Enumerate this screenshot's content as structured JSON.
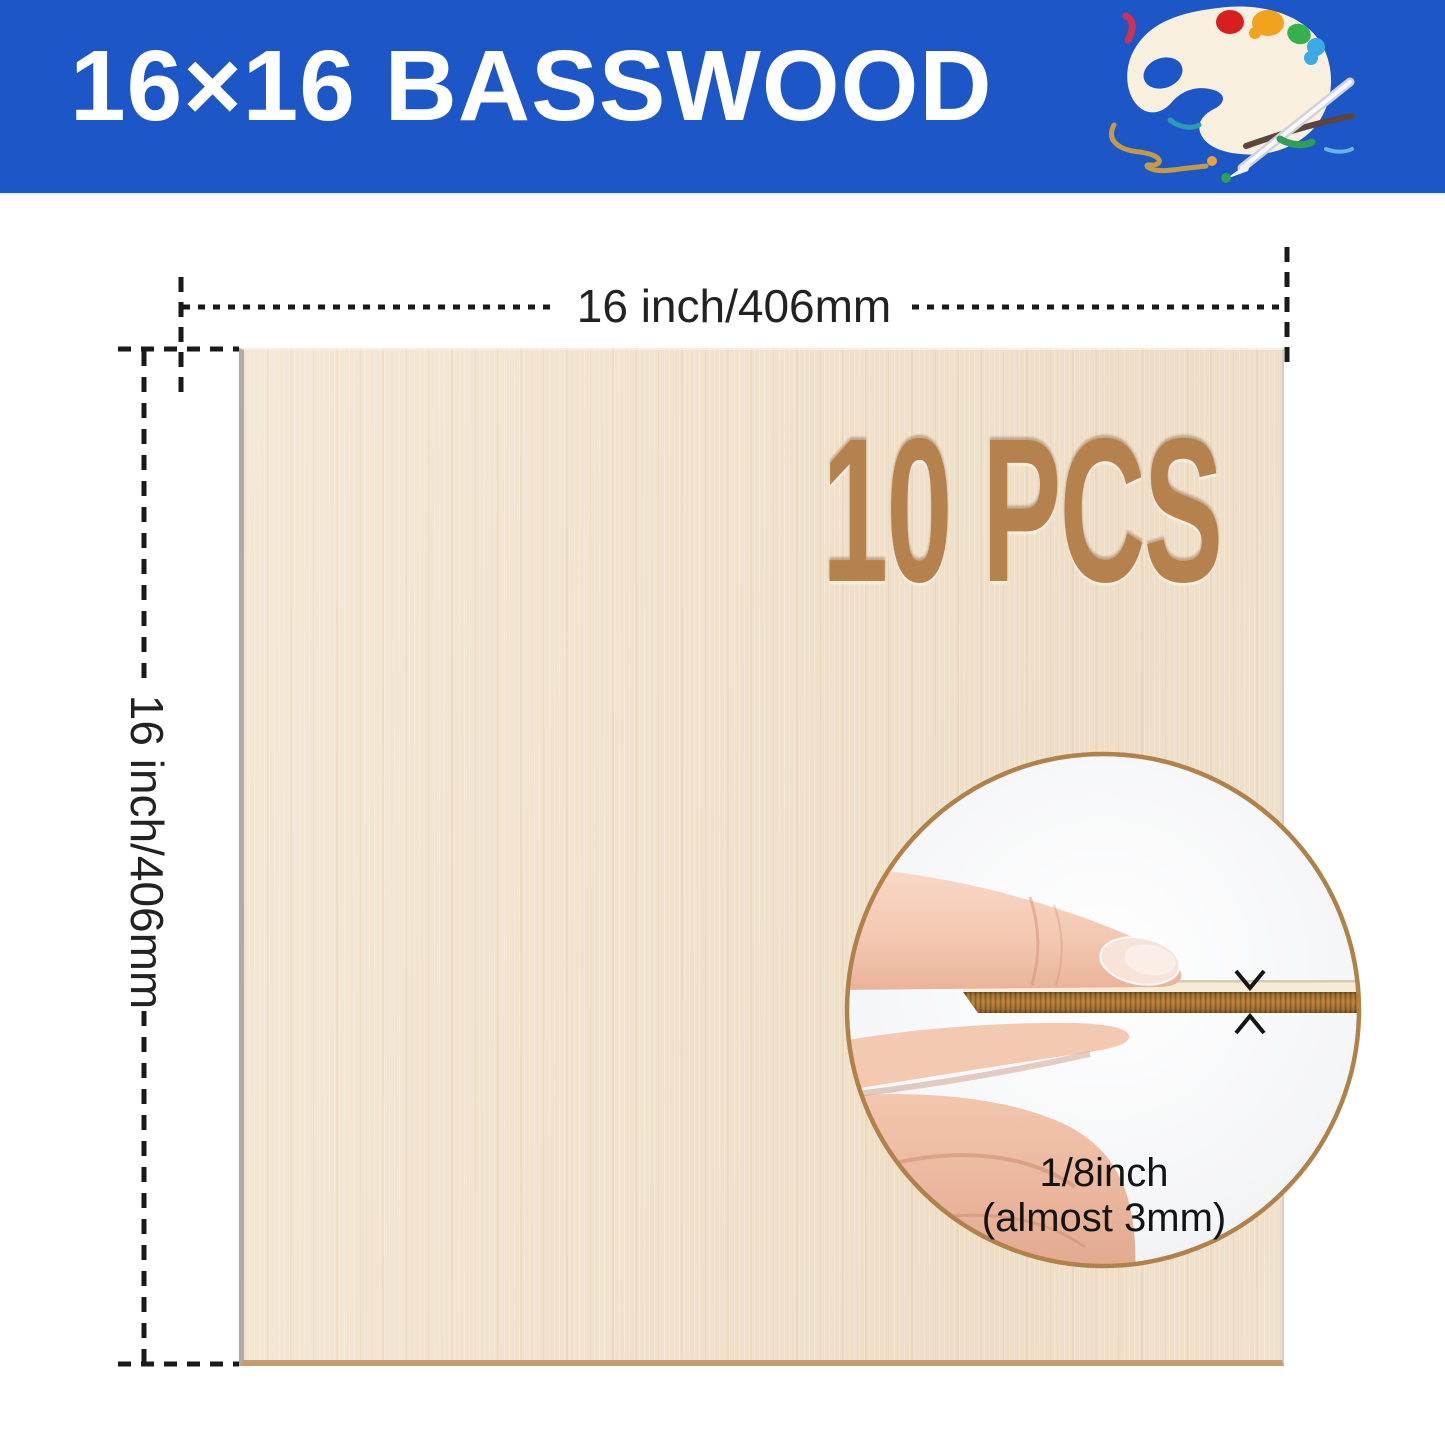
{
  "header": {
    "title": "16×16 BASSWOOD",
    "background_color": "#1d56c7",
    "title_color": "#ffffff"
  },
  "dimensions": {
    "width_label": "16 inch/406mm",
    "height_label": "16 inch/406mm",
    "line_color": "#1a1a1a"
  },
  "board": {
    "count_label": "10 PCS",
    "count_color": "#b5824e",
    "surface_color": "#f1e2cd",
    "edge_bottom_color": "#c49d72"
  },
  "inset": {
    "thickness_line1": "1/8inch",
    "thickness_line2": "(almost 3mm)",
    "ring_color": "#b08249",
    "sheet_edge_color": "#a9752f"
  },
  "icons": {
    "palette": "paint-palette"
  }
}
